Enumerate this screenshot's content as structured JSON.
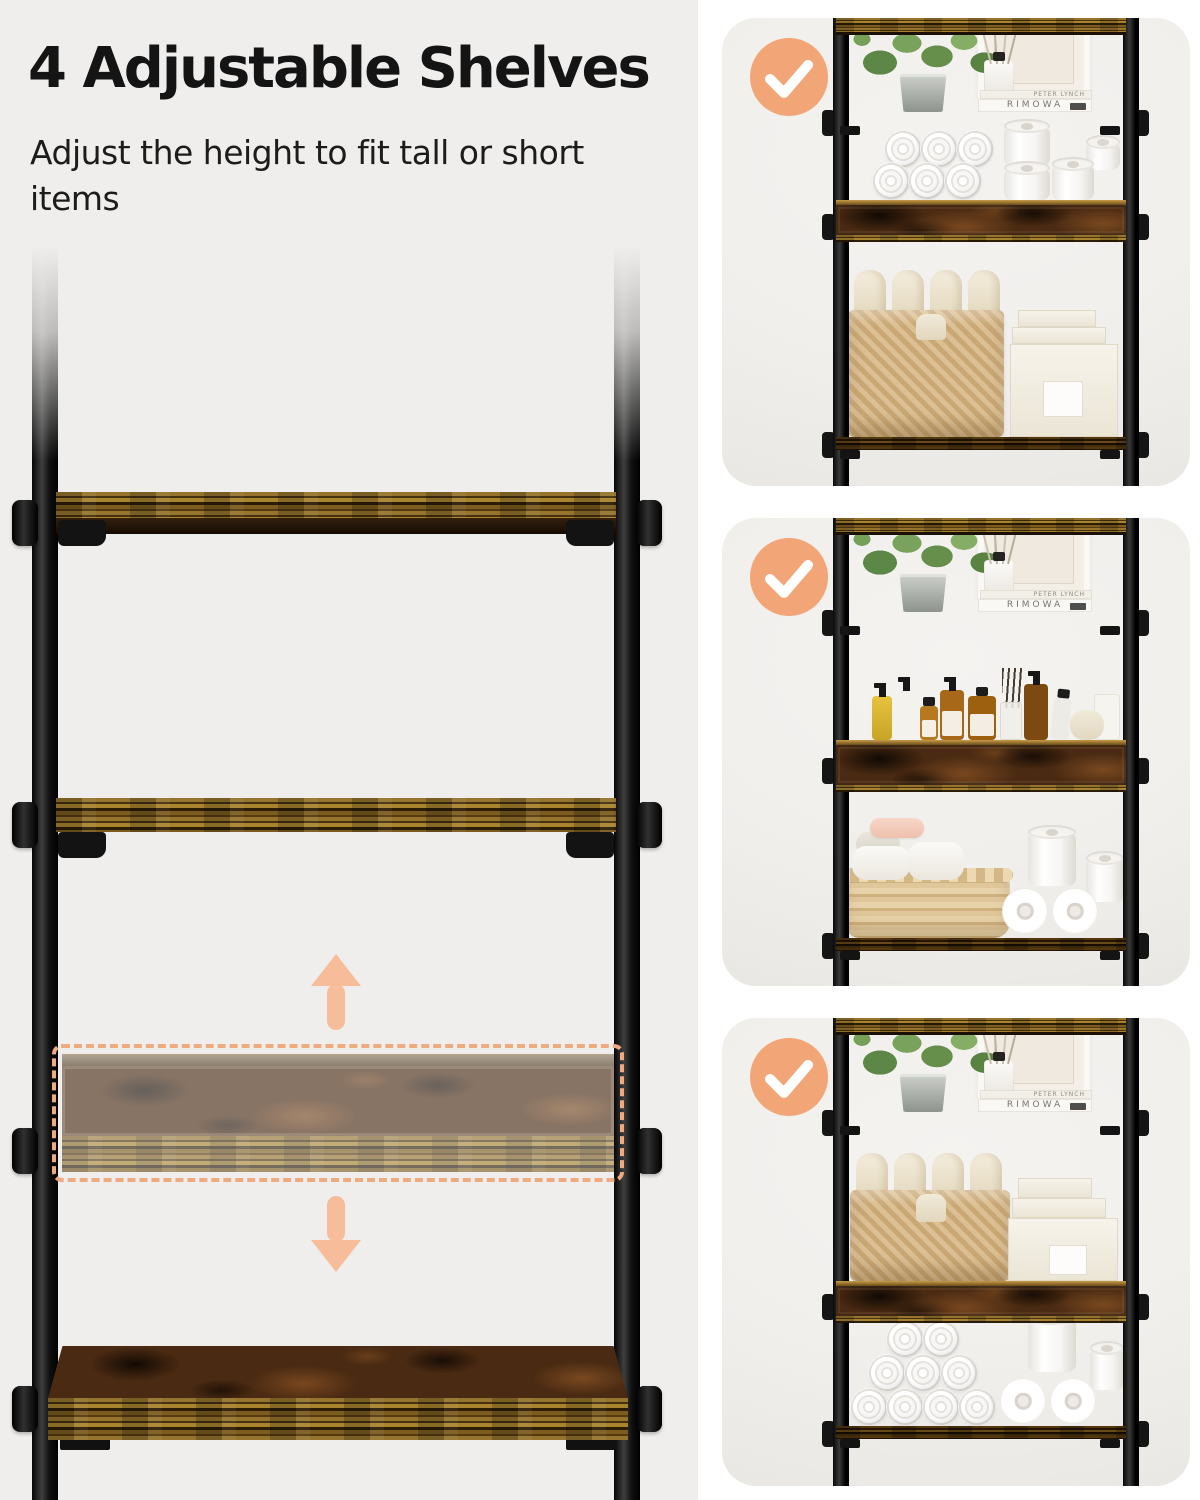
{
  "page": {
    "background": "#ffffff",
    "left_photo_background": "#efeeec",
    "panel_photo_background": "#f2f0ed"
  },
  "header": {
    "title": "4 Adjustable Shelves",
    "subtitle": "Adjust the height to fit tall or short items"
  },
  "colors": {
    "check_circle": "#f2a577",
    "check_mark": "#ffffff",
    "dashed_highlight": "#eeab80",
    "arrow": "#f7bd9a",
    "pole": "#141414",
    "wood_edge": "#8a6a2c",
    "wood_rustic": "#4a2a12"
  },
  "main_diagram": {
    "up_arrow_icon": "up-arrow-icon",
    "down_arrow_icon": "down-arrow-icon",
    "highlight_box": "adjustable-shelf-highlight"
  },
  "decor_books": {
    "author": "PETER LYNCH",
    "brand": "RIMOWA"
  },
  "panels": [
    {
      "check_icon": "checkmark-icon"
    },
    {
      "check_icon": "checkmark-icon"
    },
    {
      "check_icon": "checkmark-icon"
    }
  ]
}
